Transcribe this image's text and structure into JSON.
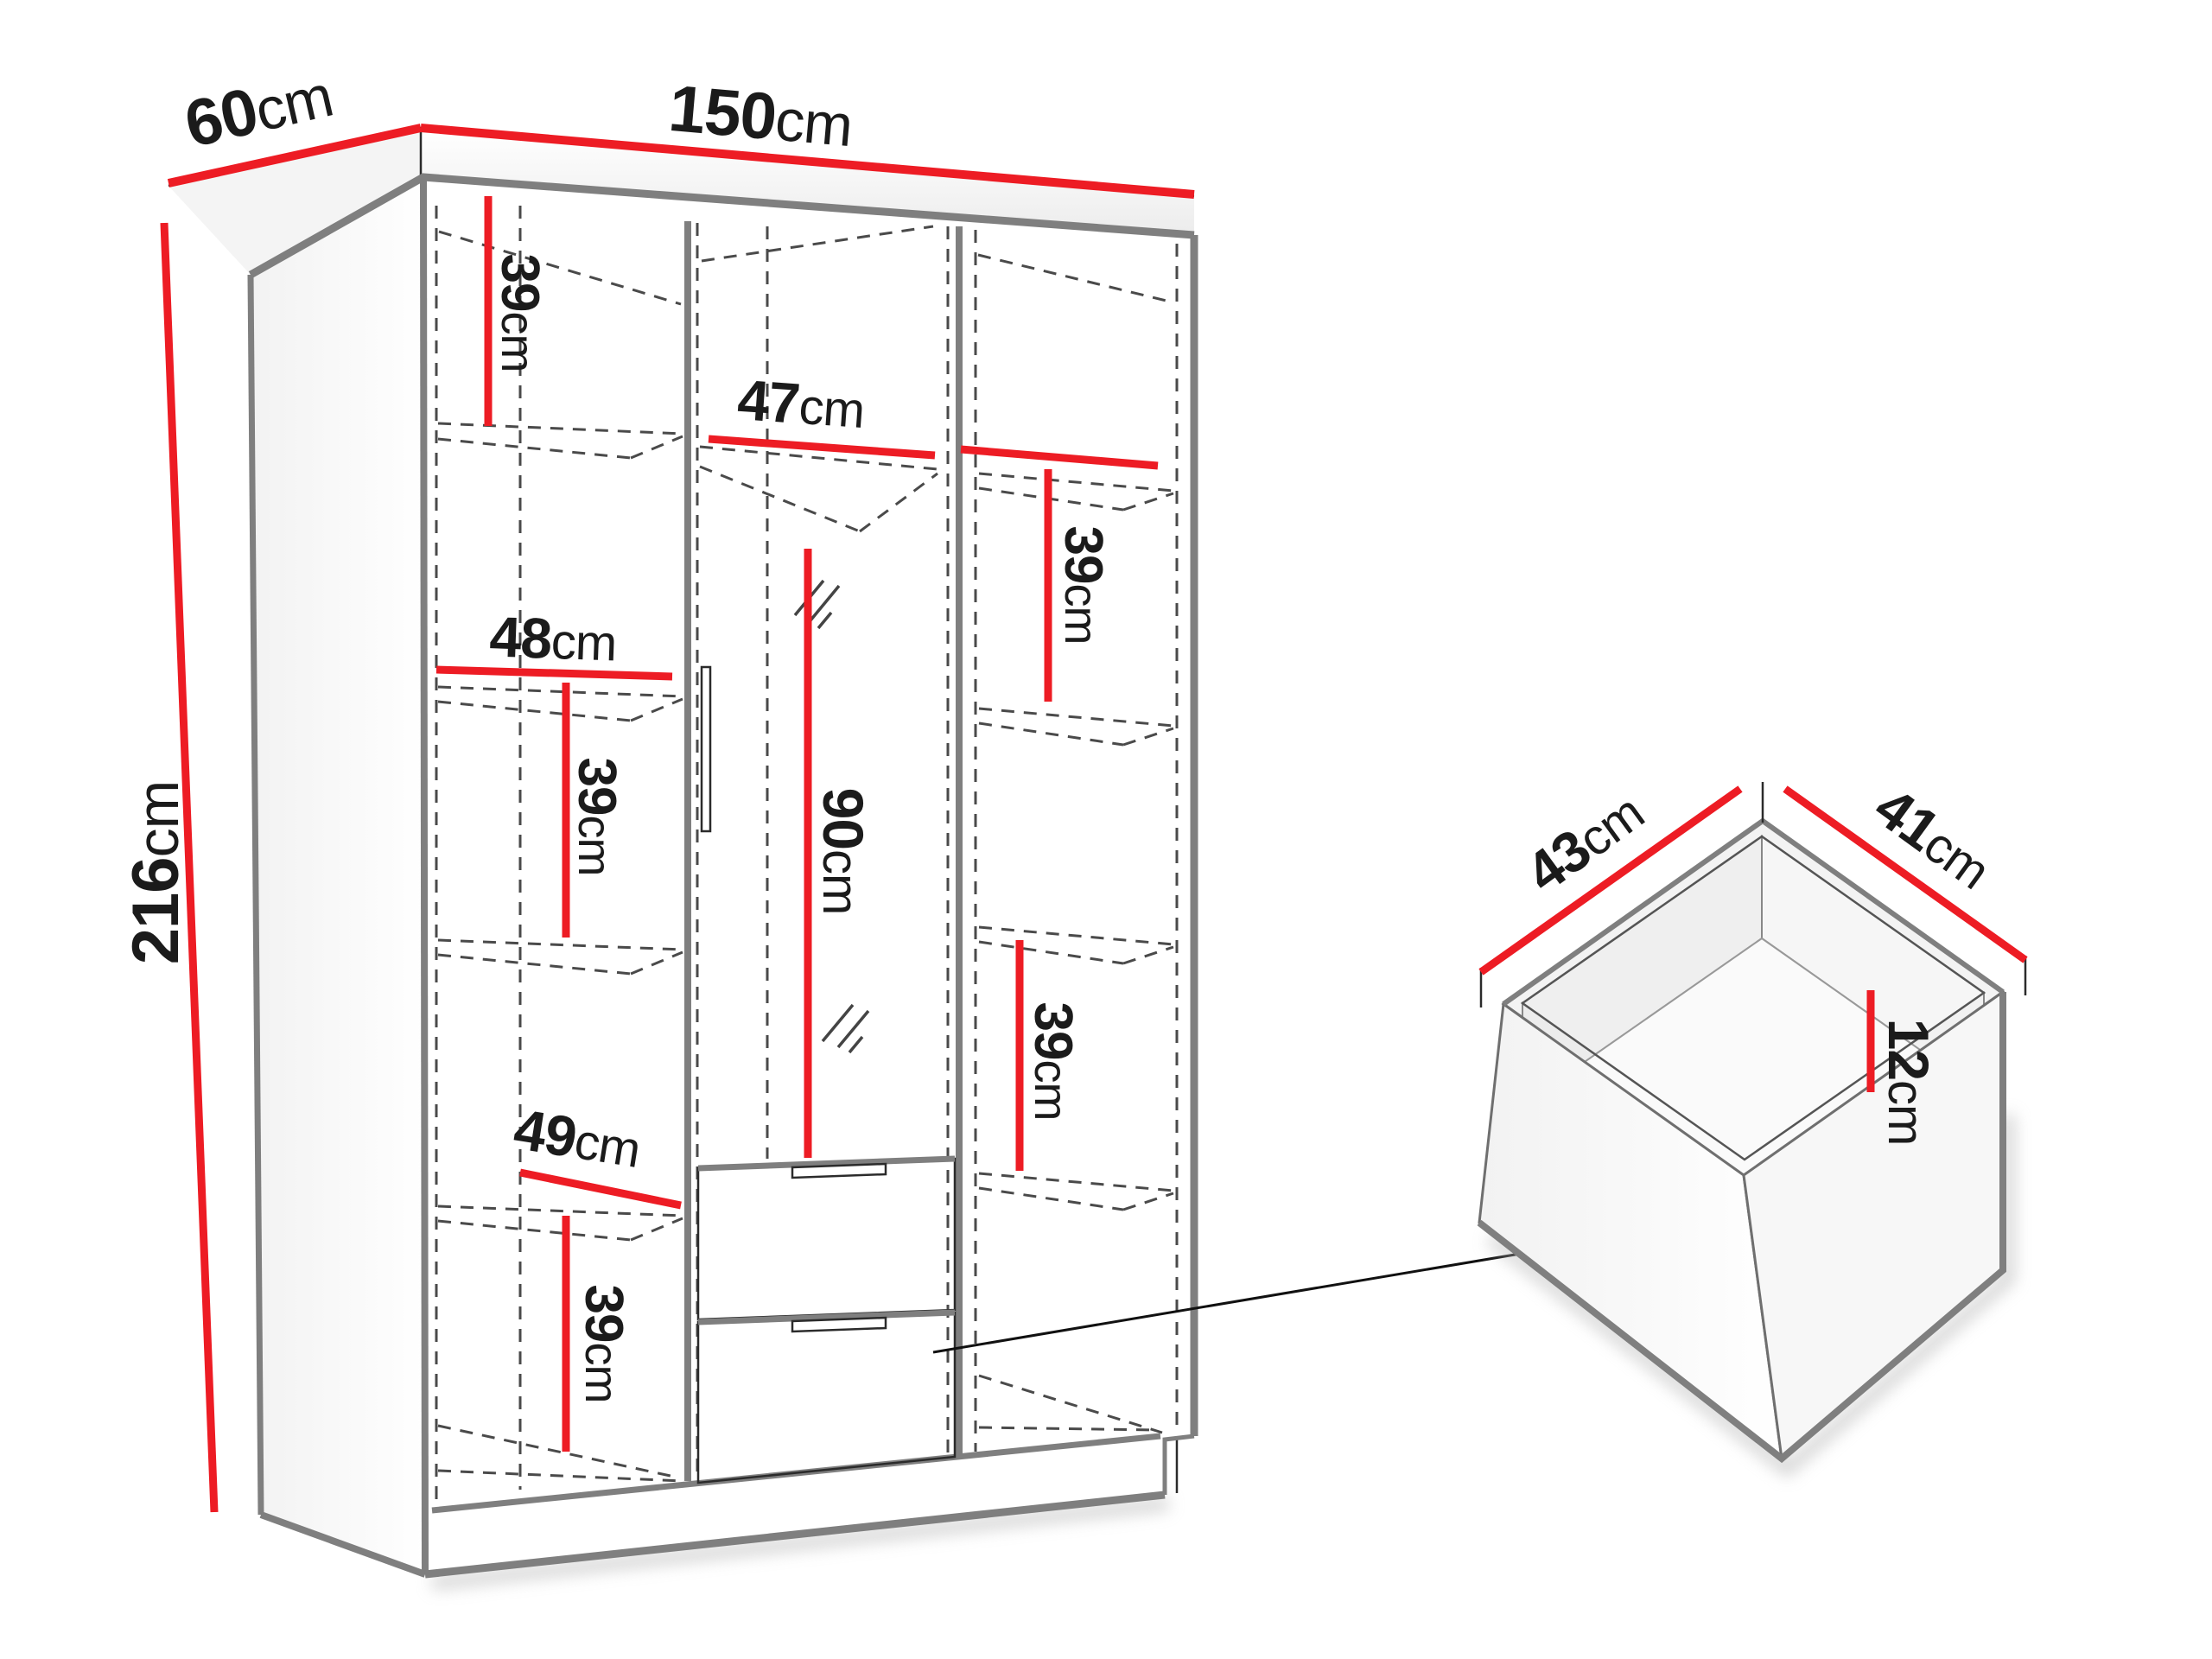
{
  "title": "Wardrobe dimensions diagram",
  "colors": {
    "dimension_line": "#ed1c24",
    "structure_line": "#7f7f7f",
    "hidden_line": "#4a4a4a",
    "label_text": "#1b1b1b",
    "background": "#ffffff"
  },
  "wardrobe": {
    "overall": {
      "width": {
        "value": "150",
        "unit": "cm"
      },
      "depth": {
        "value": "60",
        "unit": "cm"
      },
      "height": {
        "value": "216",
        "unit": "cm"
      }
    },
    "left_column": {
      "shelf_top": {
        "value": "39",
        "unit": "cm"
      },
      "width_upper": {
        "value": "48",
        "unit": "cm"
      },
      "shelf_middle": {
        "value": "39",
        "unit": "cm"
      },
      "width_lower": {
        "value": "49",
        "unit": "cm"
      },
      "shelf_bottom": {
        "value": "39",
        "unit": "cm"
      }
    },
    "middle_column": {
      "width": {
        "value": "47",
        "unit": "cm"
      },
      "hanging_height": {
        "value": "90",
        "unit": "cm"
      }
    },
    "right_column": {
      "shelf_top": {
        "value": "39",
        "unit": "cm"
      },
      "shelf_bottom": {
        "value": "39",
        "unit": "cm"
      }
    }
  },
  "drawer": {
    "width": {
      "value": "43",
      "unit": "cm"
    },
    "depth": {
      "value": "41",
      "unit": "cm"
    },
    "height": {
      "value": "12",
      "unit": "cm"
    }
  }
}
